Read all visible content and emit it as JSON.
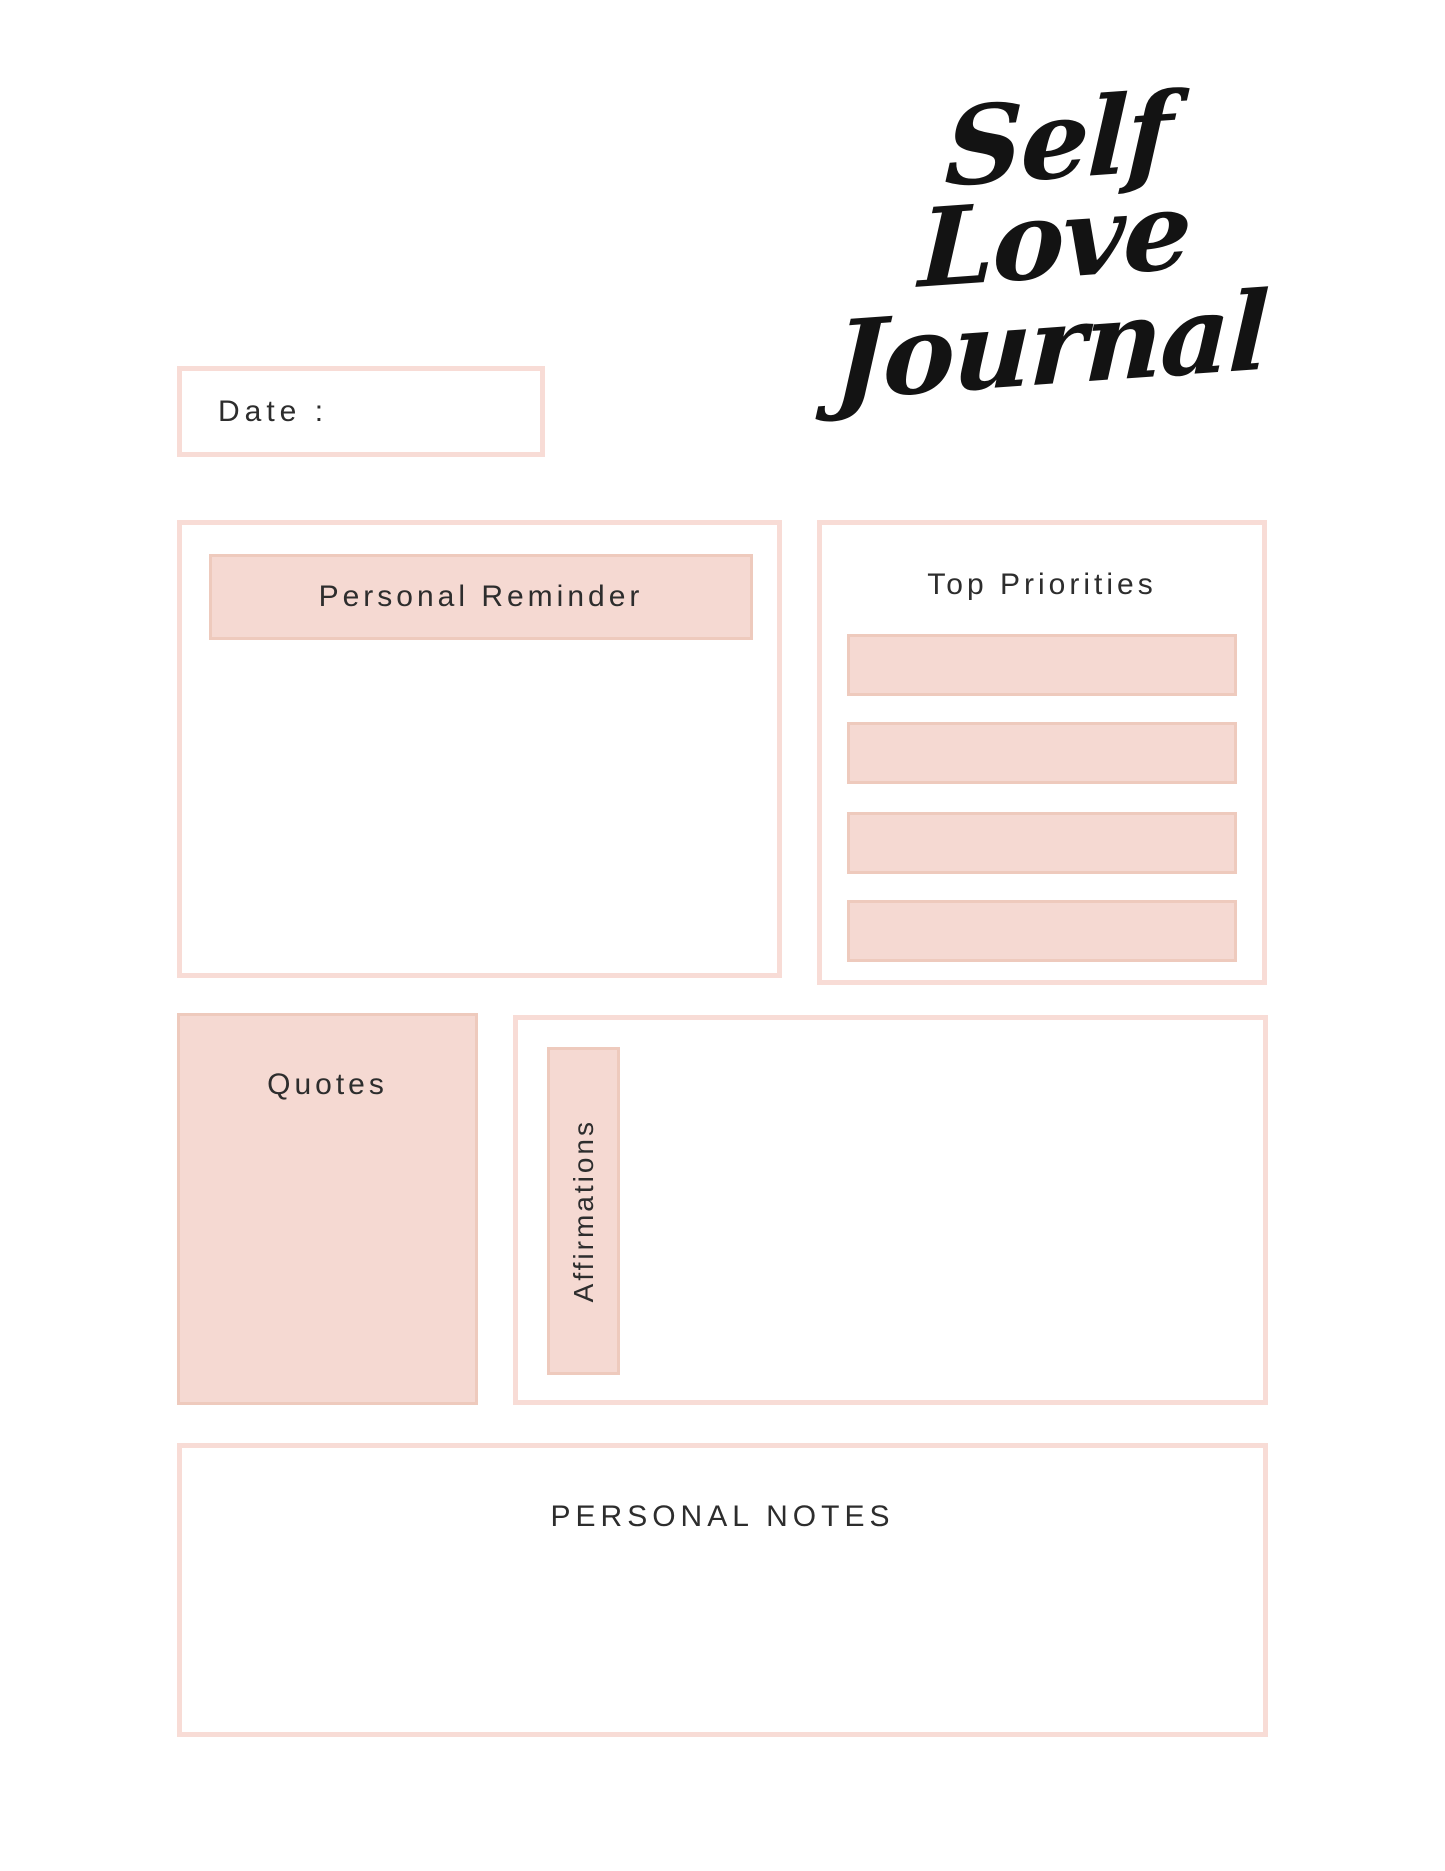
{
  "title": {
    "line1": "Self Love",
    "line2": "Journal",
    "color": "#131313"
  },
  "date": {
    "label": "Date :"
  },
  "reminder": {
    "label": "Personal Reminder"
  },
  "priorities": {
    "label": "Top Priorities",
    "slot_count": 4,
    "slots": [
      "",
      "",
      "",
      ""
    ]
  },
  "quotes": {
    "label": "Quotes"
  },
  "affirmations": {
    "label": "Affirmations"
  },
  "notes": {
    "label": "PERSONAL NOTES"
  },
  "colors": {
    "page_background": "#ffffff",
    "pink_fill": "#f5d9d2",
    "pink_fill_border": "#eecabd",
    "outline_border": "#f8dcd6",
    "text": "#2d2d2d",
    "title_text": "#131313"
  }
}
